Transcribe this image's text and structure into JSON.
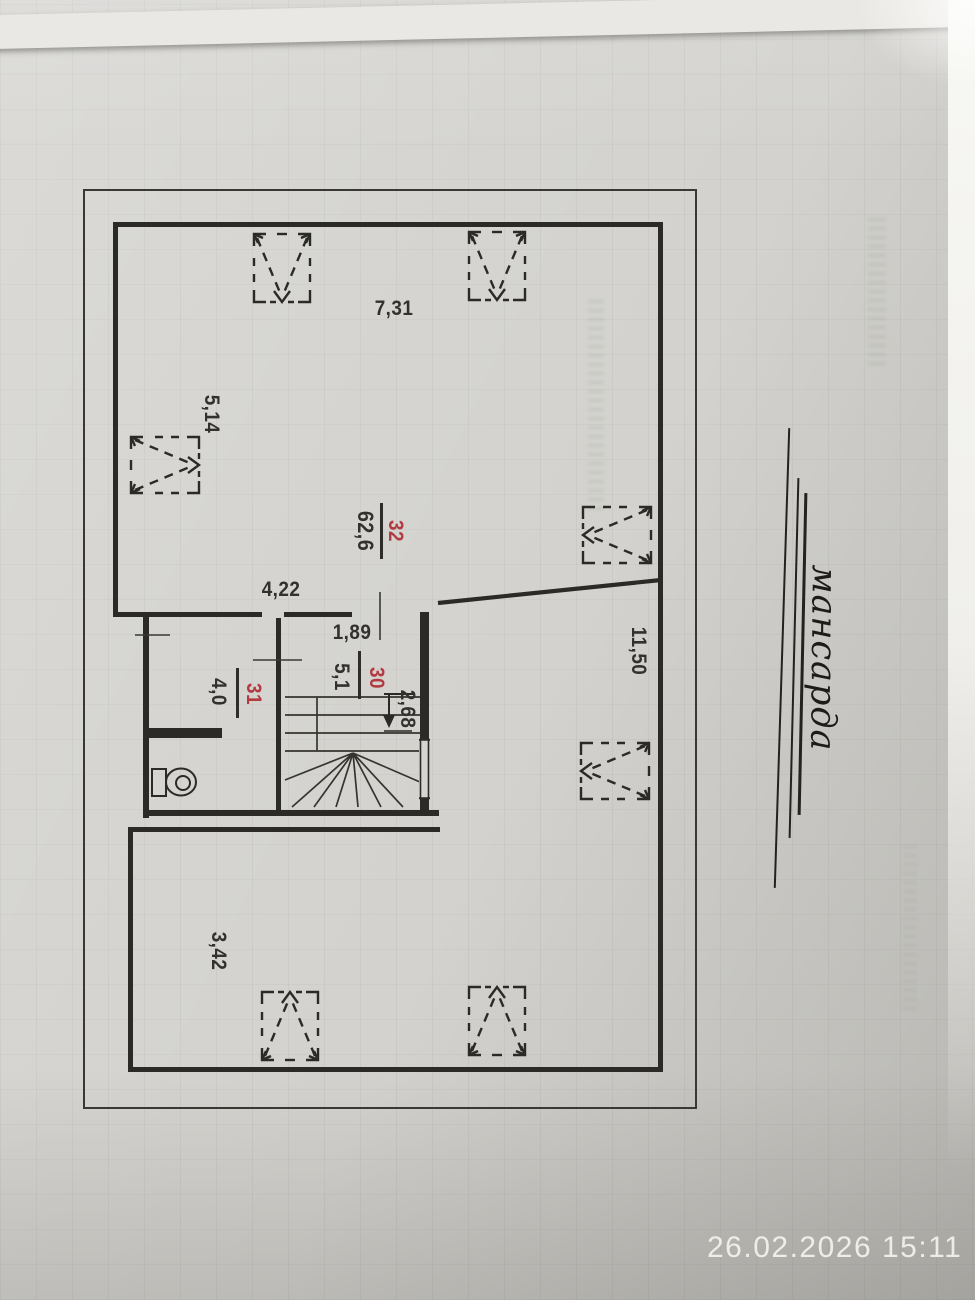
{
  "photo": {
    "camera_timestamp": "26.02.2026 15:11"
  },
  "plan": {
    "floor_title": "мансарда",
    "rooms": [
      {
        "number": "32",
        "area": "62,6"
      },
      {
        "number": "30",
        "area": "5,1"
      },
      {
        "number": "31",
        "area": "4,0"
      }
    ],
    "dimensions": {
      "top_width": "7,31",
      "left_height": "5,14",
      "right_height": "11,50",
      "bottom_height": "3,42",
      "inner_width": "4,22",
      "stair_opening": "1,89",
      "stair_depth": "2,68"
    }
  },
  "colors": {
    "room_number_red": "#b23b42",
    "wall_black": "#2b2a26",
    "paper_gray": "#d3d2ce",
    "timestamp_white": "#f1f0ea"
  },
  "icons": {
    "skylight": "roof-window-symbol",
    "toilet": "toilet-top-view",
    "stairs": "winder-stairs-symbol",
    "direction_arrow": "stair-direction-arrow-down"
  }
}
